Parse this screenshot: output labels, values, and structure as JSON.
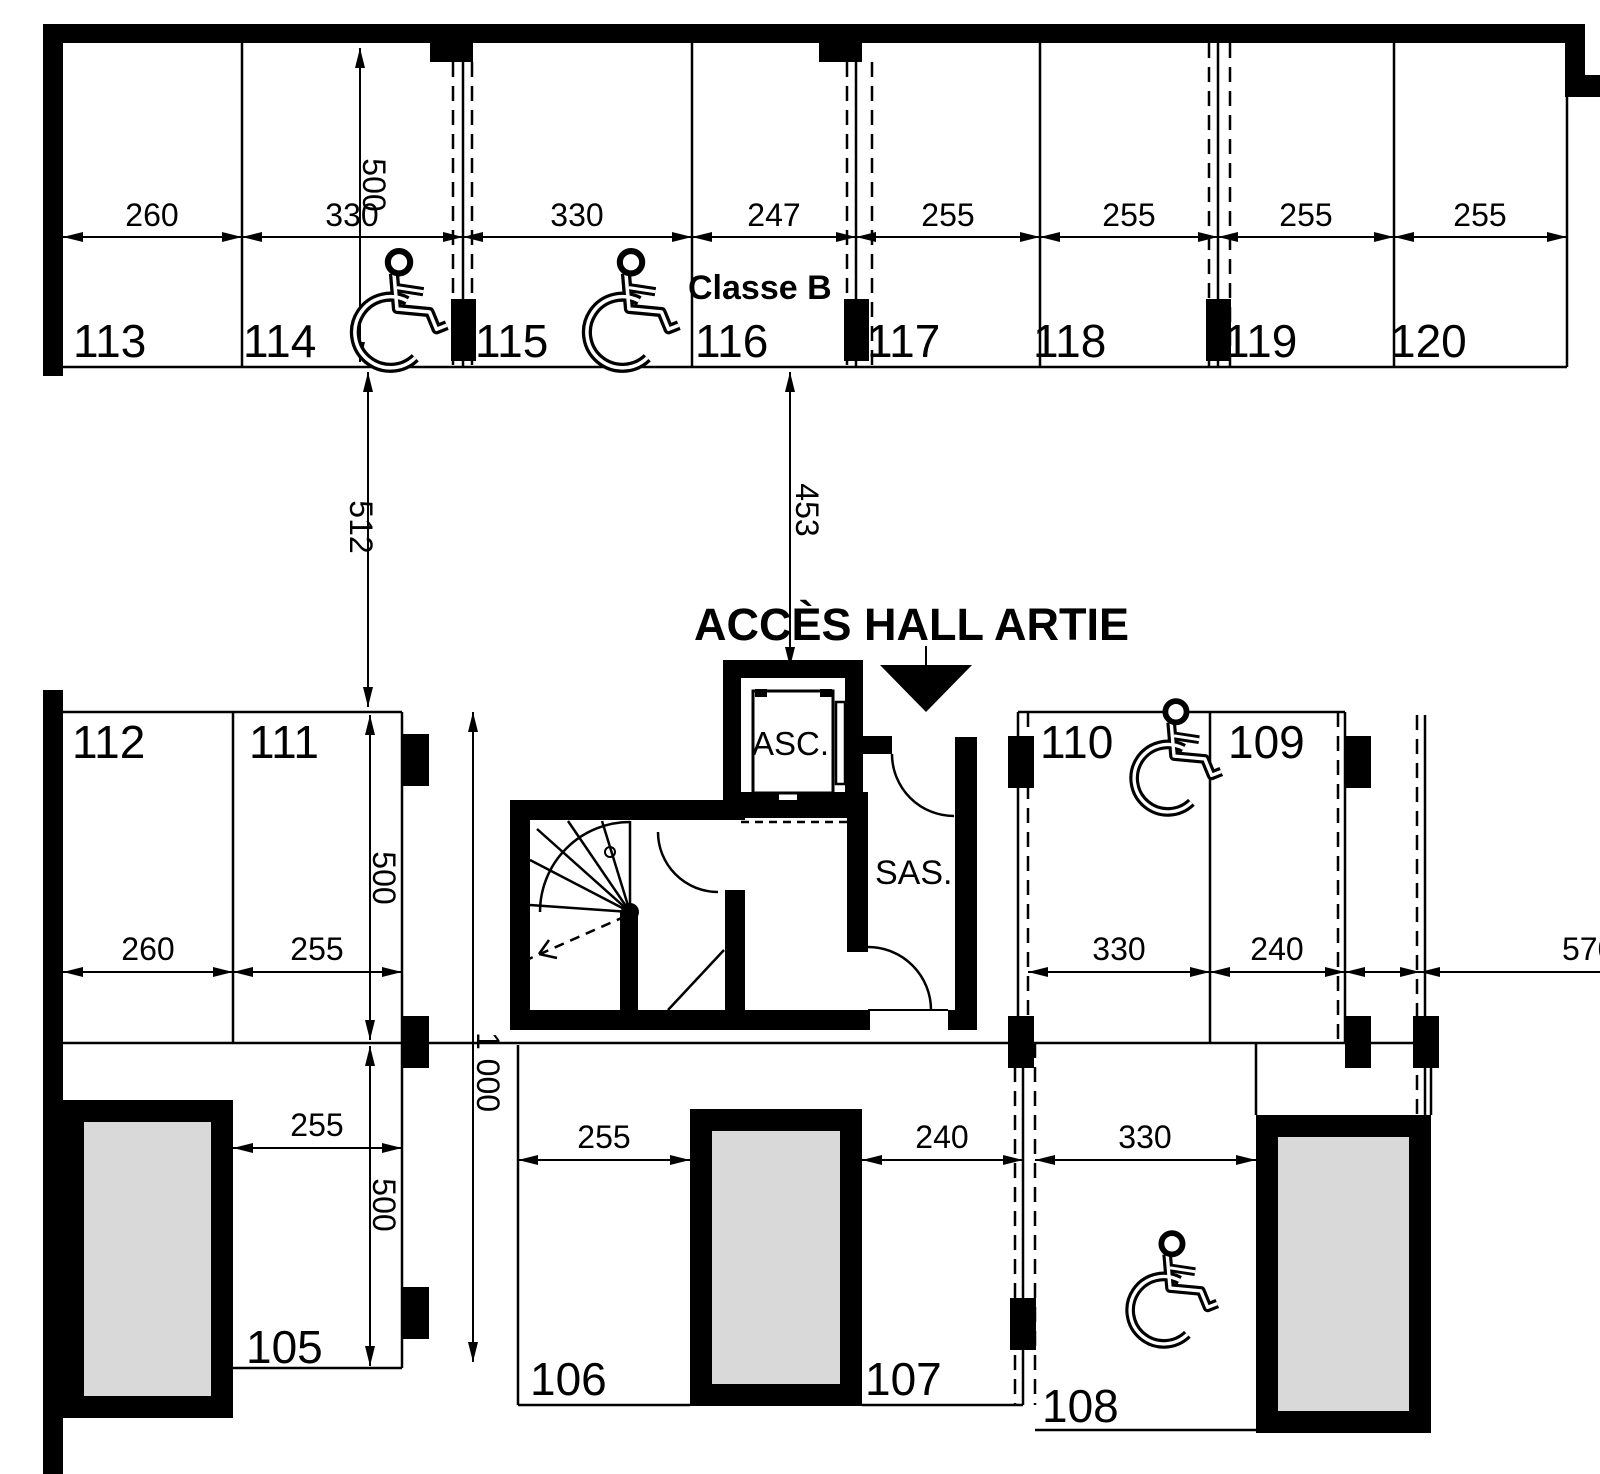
{
  "meta": {
    "bg": "#ffffff",
    "ink": "#000000",
    "shaft_fill": "#d9d9d9"
  },
  "labels": {
    "access_hall": "ACCÈS HALL ARTIE",
    "classe": "Classe B",
    "elevator": "ASC.",
    "sas": "SAS."
  },
  "spaces": {
    "numbers": [
      "105",
      "106",
      "107",
      "108",
      "109",
      "110",
      "111",
      "112",
      "113",
      "114",
      "115",
      "116",
      "117",
      "118",
      "119",
      "120"
    ]
  },
  "dims": {
    "top_row": [
      "260",
      "330",
      "330",
      "247",
      "255",
      "255",
      "255",
      "255"
    ],
    "top_depth": "500",
    "aisle_left": "512",
    "hall_access": "453",
    "left_row": [
      "260",
      "255"
    ],
    "left_depth": "500",
    "p105_width": "255",
    "p105_depth": "500",
    "corridor_length": "1 000",
    "p106_width": "255",
    "p107_width": "240",
    "p108_width": "330",
    "p110_width": "330",
    "p109_width": "240",
    "right_edge": "570"
  }
}
